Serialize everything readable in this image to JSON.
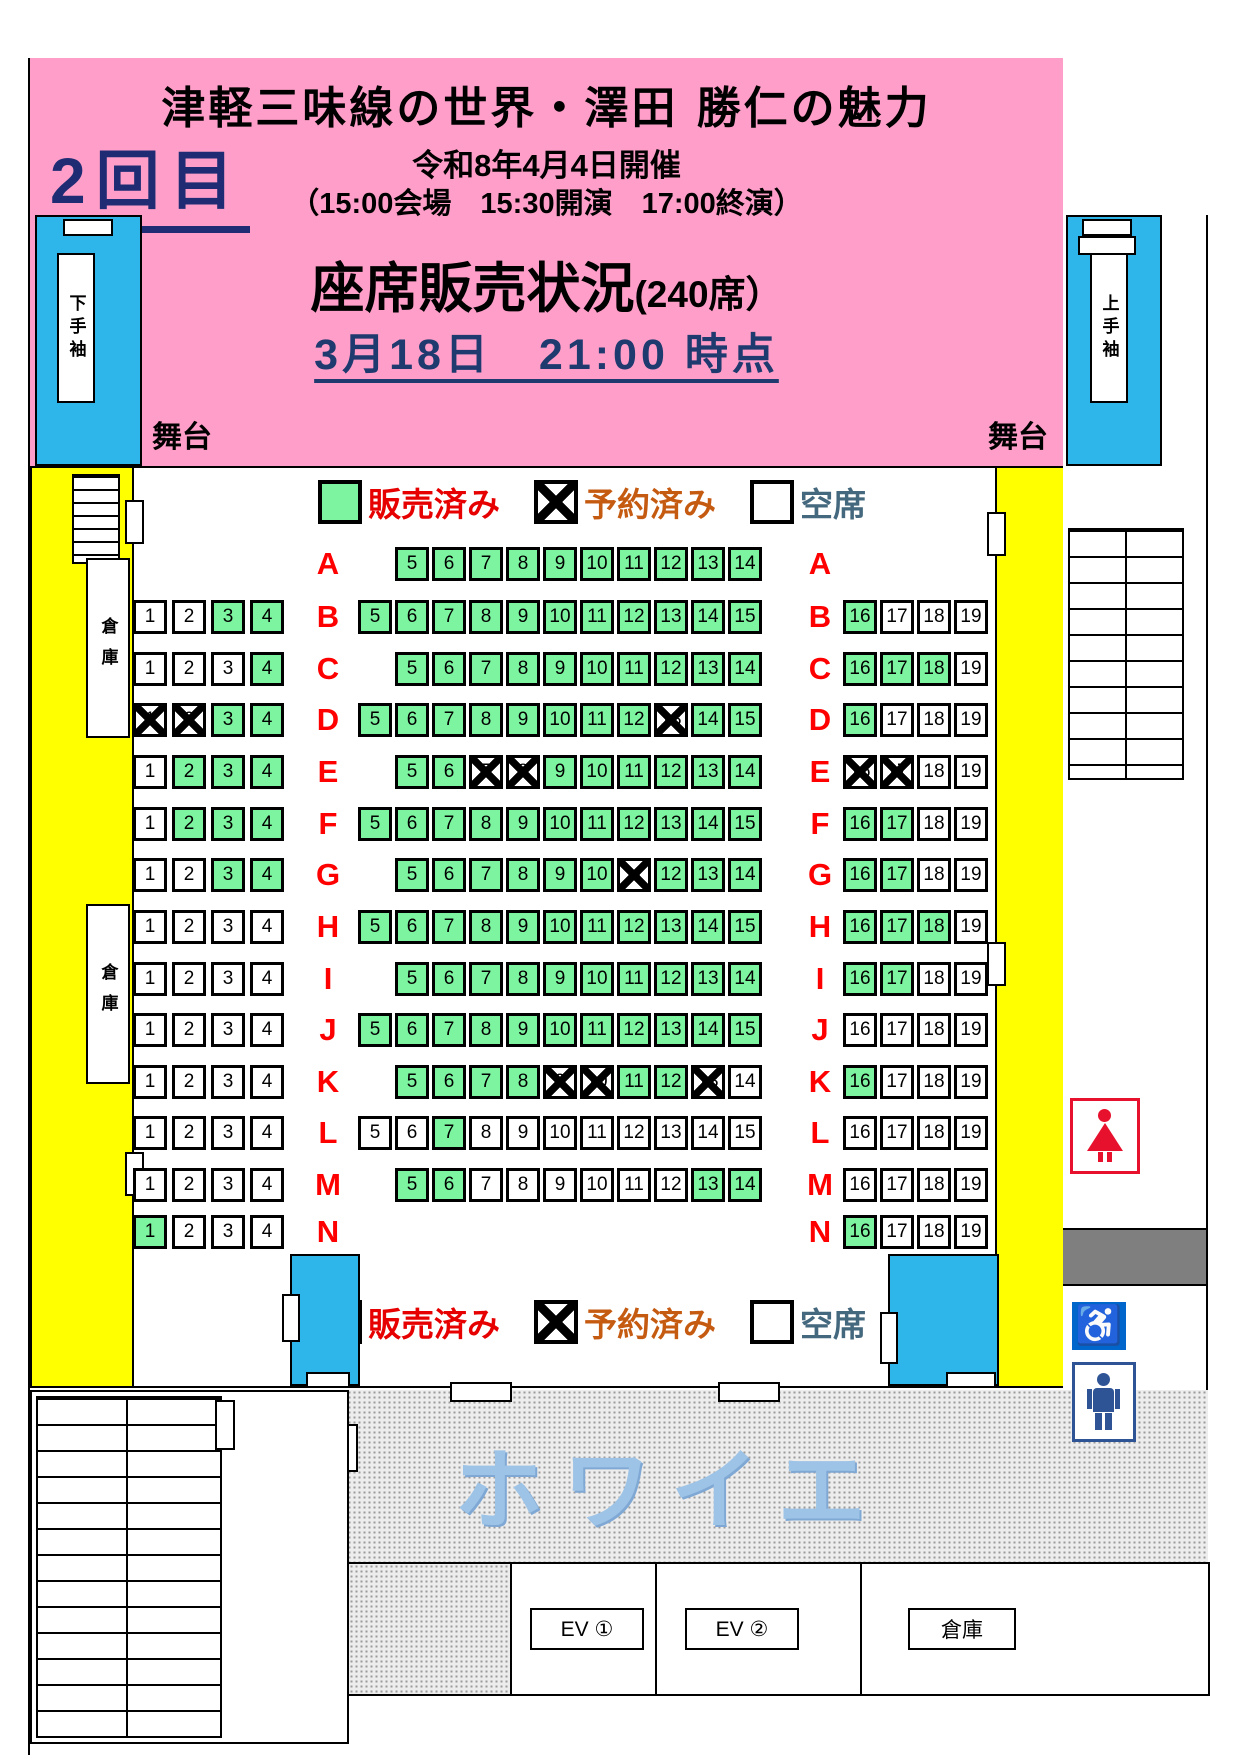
{
  "header": {
    "title": "津軽三味線の世界・澤田 勝仁の魅力",
    "round": "2回目",
    "date_line": "令和8年4月4日開催",
    "time_line": "（15:00会場　15:30開演　17:00終演）",
    "sales_title_main": "座席販売状況",
    "sales_title_capacity": "(240席）",
    "asof_line": "3月18日　21:00  時点"
  },
  "stage": {
    "left_label": "舞台",
    "right_label": "舞台"
  },
  "wings": {
    "left": "下手袖",
    "right": "上手袖"
  },
  "storage_label": "倉庫",
  "legend": {
    "sold": "販売済み",
    "reserved": "予約済み",
    "empty": "空席"
  },
  "foyer_label": "ホワイエ",
  "facilities": {
    "ev1": "EV ①",
    "ev2": "EV ②",
    "storage": "倉庫"
  },
  "colors": {
    "sold_green": "#7DF5A0",
    "header_pink": "#FF9FC9",
    "wall_yellow": "#FFFF00",
    "wing_cyan": "#2EB6EA",
    "legend_sold_text": "#E60000",
    "legend_reserved_text": "#C55A11",
    "legend_empty_text": "#44687D",
    "row_letter_red": "#FF0000",
    "wheelchair_blue": "#0066CC"
  },
  "seatmap": {
    "numbering": {
      "left_start": 1,
      "center_start": 5,
      "right_start": 16
    },
    "state_key": {
      "s": "sold",
      "r": "reserved",
      "e": "empty"
    },
    "rows": [
      {
        "label": "A",
        "left": null,
        "center": [
          "s",
          "s",
          "s",
          "s",
          "s",
          "s",
          "s",
          "s",
          "s",
          "s"
        ],
        "right": null
      },
      {
        "label": "B",
        "left": [
          "e",
          "e",
          "s",
          "s"
        ],
        "center": [
          "s",
          "s",
          "s",
          "s",
          "s",
          "s",
          "s",
          "s",
          "s",
          "s",
          "s"
        ],
        "right": [
          "s",
          "e",
          "e",
          "e"
        ]
      },
      {
        "label": "C",
        "left": [
          "e",
          "e",
          "e",
          "s"
        ],
        "center": [
          "s",
          "s",
          "s",
          "s",
          "s",
          "s",
          "s",
          "s",
          "s",
          "s"
        ],
        "right": [
          "s",
          "s",
          "s",
          "e"
        ]
      },
      {
        "label": "D",
        "left": [
          "r",
          "r",
          "s",
          "s"
        ],
        "center": [
          "s",
          "s",
          "s",
          "s",
          "s",
          "s",
          "s",
          "s",
          "r",
          "s",
          "s"
        ],
        "right": [
          "s",
          "e",
          "e",
          "e"
        ]
      },
      {
        "label": "E",
        "left": [
          "e",
          "s",
          "s",
          "s"
        ],
        "center": [
          "s",
          "s",
          "r",
          "r",
          "s",
          "s",
          "s",
          "s",
          "s",
          "s"
        ],
        "right": [
          "r",
          "r",
          "e",
          "e"
        ]
      },
      {
        "label": "F",
        "left": [
          "e",
          "s",
          "s",
          "s"
        ],
        "center": [
          "s",
          "s",
          "s",
          "s",
          "s",
          "s",
          "s",
          "s",
          "s",
          "s",
          "s"
        ],
        "right": [
          "s",
          "s",
          "e",
          "e"
        ]
      },
      {
        "label": "G",
        "left": [
          "e",
          "e",
          "s",
          "s"
        ],
        "center": [
          "s",
          "s",
          "s",
          "s",
          "s",
          "s",
          "r",
          "s",
          "s",
          "s"
        ],
        "right": [
          "s",
          "s",
          "e",
          "e"
        ]
      },
      {
        "label": "H",
        "left": [
          "e",
          "e",
          "e",
          "e"
        ],
        "center": [
          "s",
          "s",
          "s",
          "s",
          "s",
          "s",
          "s",
          "s",
          "s",
          "s",
          "s"
        ],
        "right": [
          "s",
          "s",
          "s",
          "e"
        ]
      },
      {
        "label": "I",
        "left": [
          "e",
          "e",
          "e",
          "e"
        ],
        "center": [
          "s",
          "s",
          "s",
          "s",
          "s",
          "s",
          "s",
          "s",
          "s",
          "s"
        ],
        "right": [
          "s",
          "s",
          "e",
          "e"
        ]
      },
      {
        "label": "J",
        "left": [
          "e",
          "e",
          "e",
          "e"
        ],
        "center": [
          "s",
          "s",
          "s",
          "s",
          "s",
          "s",
          "s",
          "s",
          "s",
          "s",
          "s"
        ],
        "right": [
          "e",
          "e",
          "e",
          "e"
        ]
      },
      {
        "label": "K",
        "left": [
          "e",
          "e",
          "e",
          "e"
        ],
        "center": [
          "s",
          "s",
          "s",
          "s",
          "r",
          "r",
          "s",
          "s",
          "r",
          "e"
        ],
        "right": [
          "s",
          "e",
          "e",
          "e"
        ]
      },
      {
        "label": "L",
        "left": [
          "e",
          "e",
          "e",
          "e"
        ],
        "center": [
          "e",
          "e",
          "s",
          "e",
          "e",
          "e",
          "e",
          "e",
          "e",
          "e",
          "e"
        ],
        "right": [
          "e",
          "e",
          "e",
          "e"
        ]
      },
      {
        "label": "M",
        "left": [
          "e",
          "e",
          "e",
          "e"
        ],
        "center": [
          "s",
          "s",
          "e",
          "e",
          "e",
          "e",
          "e",
          "e",
          "s",
          "s"
        ],
        "right": [
          "e",
          "e",
          "e",
          "e"
        ]
      },
      {
        "label": "N",
        "left": [
          "s",
          "e",
          "e",
          "e"
        ],
        "center": null,
        "right": [
          "s",
          "e",
          "e",
          "e"
        ]
      }
    ]
  }
}
